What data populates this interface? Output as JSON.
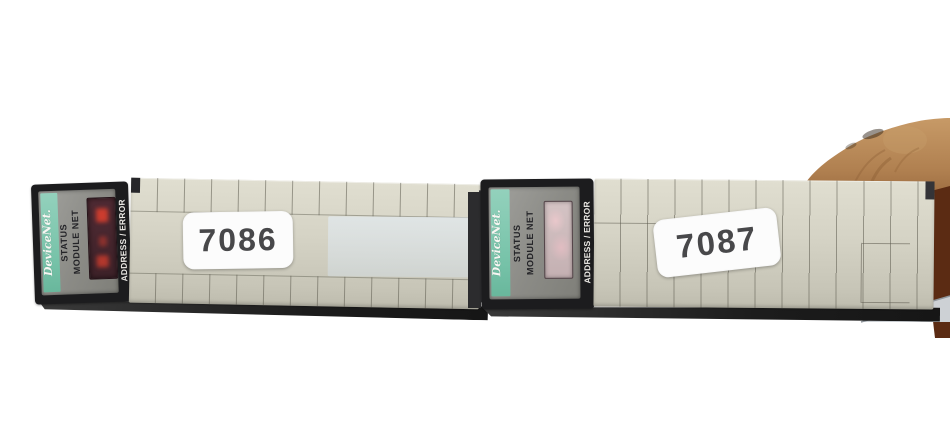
{
  "scene": {
    "description": "Photograph of two DeviceNet interface modules lying on a white background, fingers holding the right module at top right",
    "background": "#ffffff"
  },
  "modules": [
    {
      "tag_number": "7086",
      "faceplate": {
        "brand": "DeviceNet.",
        "status_label": "STATUS",
        "module_net_label": "MODULE NET",
        "address_error_label": "ADDRESS / ERROR"
      },
      "display_condition": "dark red LED window with faint lit segments"
    },
    {
      "tag_number": "7087",
      "faceplate": {
        "brand": "DeviceNet.",
        "status_label": "STATUS",
        "module_net_label": "MODULE NET",
        "address_error_label": "ADDRESS / ERROR"
      },
      "display_condition": "window covered / faded pink"
    }
  ],
  "colors": {
    "background": "#ffffff",
    "module_body": "#d5d3c5",
    "vent_line": "#5c5a4e",
    "faceplate_frame": "#1c1c1e",
    "faceplate_gray": "#90908c",
    "brand_teal": "#7fc7ae",
    "led_window": "#45262e",
    "led_red": "#e2402e",
    "covered_window": "#c9b6b8",
    "sticker_white": "#fcfcfc",
    "digit_gray": "#48484a",
    "shadow": "#1f1f1f",
    "skin_tone": "#b08050"
  }
}
